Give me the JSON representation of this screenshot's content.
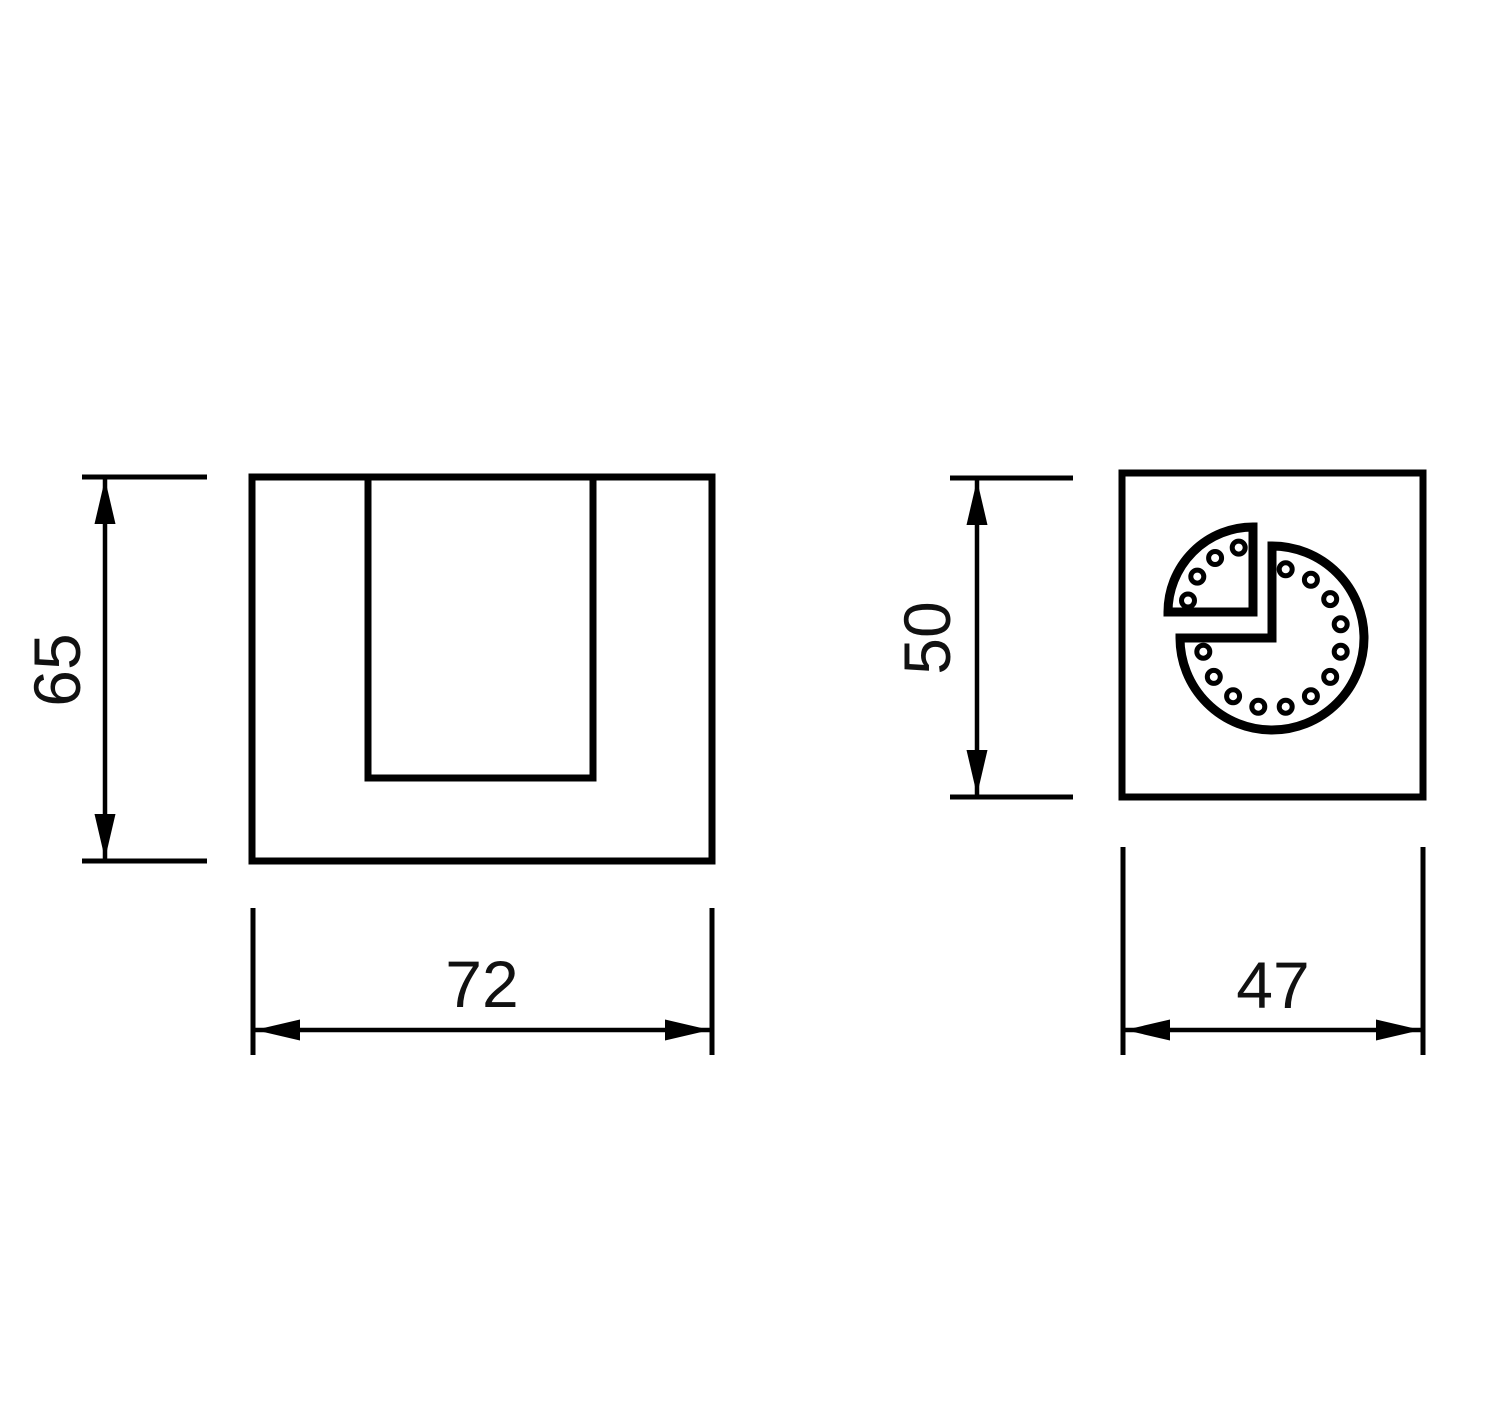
{
  "colors": {
    "background": "#ffffff",
    "line": "#000000",
    "text": "#111111"
  },
  "drawing": {
    "front_view": {
      "height_dimension": "65",
      "width_dimension": "72"
    },
    "side_view": {
      "height_dimension": "50",
      "width_dimension": "47"
    }
  }
}
